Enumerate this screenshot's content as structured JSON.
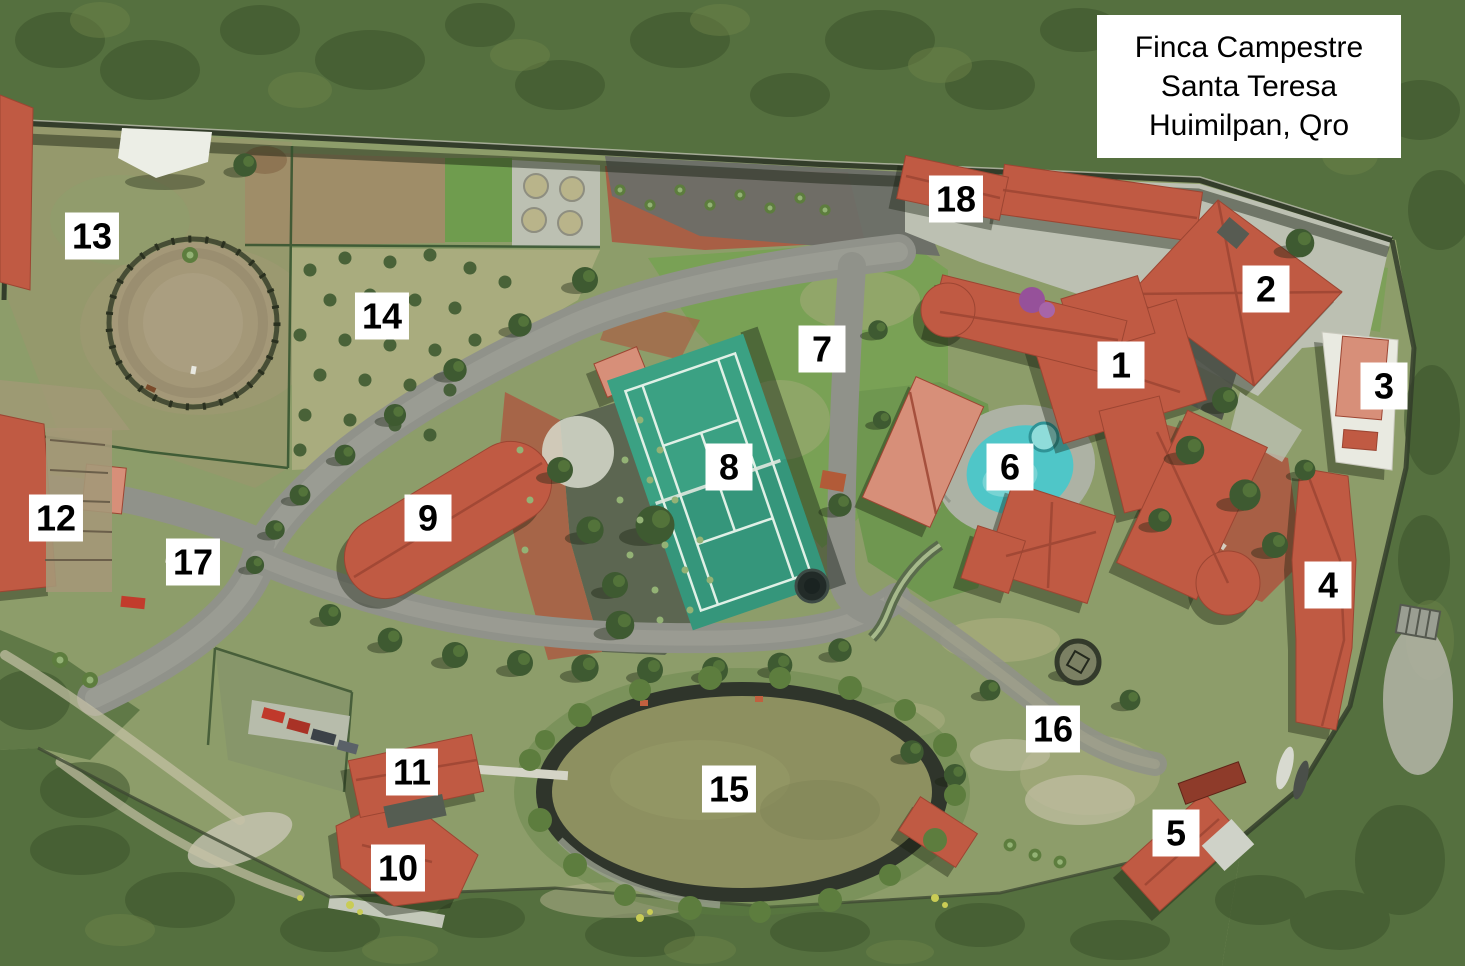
{
  "title": {
    "lines": [
      "Finca Campestre",
      "Santa Teresa",
      "Huimilpan, Qro"
    ]
  },
  "map": {
    "markers": [
      {
        "number": "1",
        "x": 1121,
        "y": 365
      },
      {
        "number": "2",
        "x": 1266,
        "y": 289
      },
      {
        "number": "3",
        "x": 1384,
        "y": 386
      },
      {
        "number": "4",
        "x": 1328,
        "y": 585
      },
      {
        "number": "5",
        "x": 1176,
        "y": 833
      },
      {
        "number": "6",
        "x": 1010,
        "y": 467
      },
      {
        "number": "7",
        "x": 822,
        "y": 349
      },
      {
        "number": "8",
        "x": 729,
        "y": 467
      },
      {
        "number": "9",
        "x": 428,
        "y": 518
      },
      {
        "number": "10",
        "x": 398,
        "y": 868
      },
      {
        "number": "11",
        "x": 412,
        "y": 772
      },
      {
        "number": "12",
        "x": 56,
        "y": 518
      },
      {
        "number": "13",
        "x": 92,
        "y": 236
      },
      {
        "number": "14",
        "x": 382,
        "y": 316
      },
      {
        "number": "15",
        "x": 729,
        "y": 789
      },
      {
        "number": "16",
        "x": 1053,
        "y": 729
      },
      {
        "number": "17",
        "x": 193,
        "y": 562
      },
      {
        "number": "18",
        "x": 956,
        "y": 199
      }
    ]
  },
  "colors": {
    "label_bg": "#ffffff",
    "label_text": "#000000",
    "scrub": "#55703f",
    "scrub_dark": "#3d532c",
    "scrub_light": "#6e8449",
    "grass": "#8d9d6a",
    "lawn": "#79a155",
    "drygrass": "#a9ac7e",
    "dirt": "#a49878",
    "soil": "#9f8d68",
    "road": "#90928a",
    "asphalt": "#6b6e68",
    "concrete": "#bcc0b2",
    "wall": "#333d2a",
    "mulch": "#a85f45",
    "gravel": "#5a6350",
    "roof": "#c05a43",
    "roof_light": "#d78f79",
    "roof_dark": "#9c4532",
    "court": "#3ba183",
    "court_line": "#dff0e6",
    "pond": "#8d9060",
    "pond_rim": "#2f352b",
    "pool": "#4fc6c8",
    "pool_light": "#8fdcda",
    "stone": "#adb2a4",
    "tree": "#3e5a31",
    "tree_light": "#5d7d3e",
    "white_struct": "#e9eae1"
  }
}
